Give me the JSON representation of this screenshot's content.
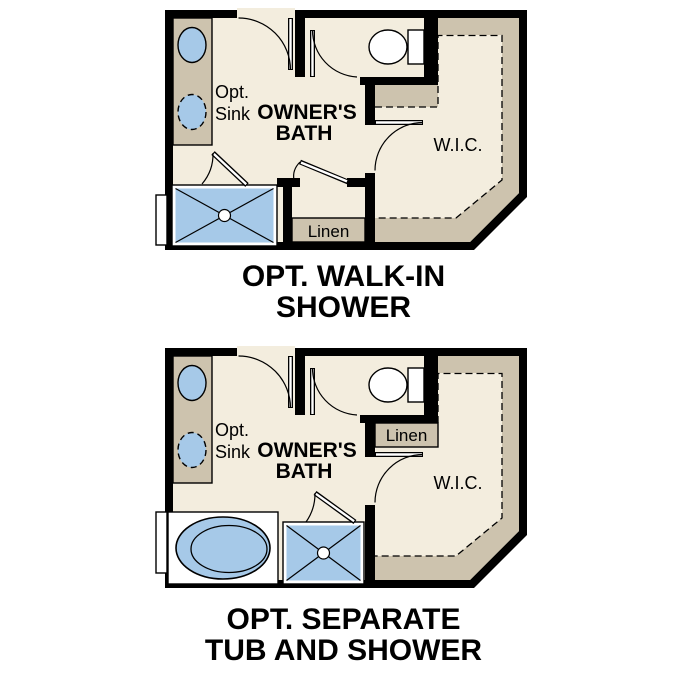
{
  "page": {
    "background": "#ffffff"
  },
  "colors": {
    "wall": "#000000",
    "floor": "#f3edde",
    "tan": "#cdc3ae",
    "blue": "#a6c9e8"
  },
  "plans": [
    {
      "id": "walk-in-shower",
      "labels": {
        "opt_line1": "Opt.",
        "opt_line2": "Sink",
        "bath_line1": "OWNER'S",
        "bath_line2": "BATH",
        "linen": "Linen",
        "wic": "W.I.C."
      },
      "caption": {
        "line1": "OPT. WALK-IN",
        "line2": "SHOWER"
      }
    },
    {
      "id": "separate-tub-and-shower",
      "labels": {
        "opt_line1": "Opt.",
        "opt_line2": "Sink",
        "bath_line1": "OWNER'S",
        "bath_line2": "BATH",
        "linen": "Linen",
        "wic": "W.I.C."
      },
      "caption": {
        "line1": "OPT. SEPARATE",
        "line2": "TUB AND SHOWER"
      }
    }
  ]
}
